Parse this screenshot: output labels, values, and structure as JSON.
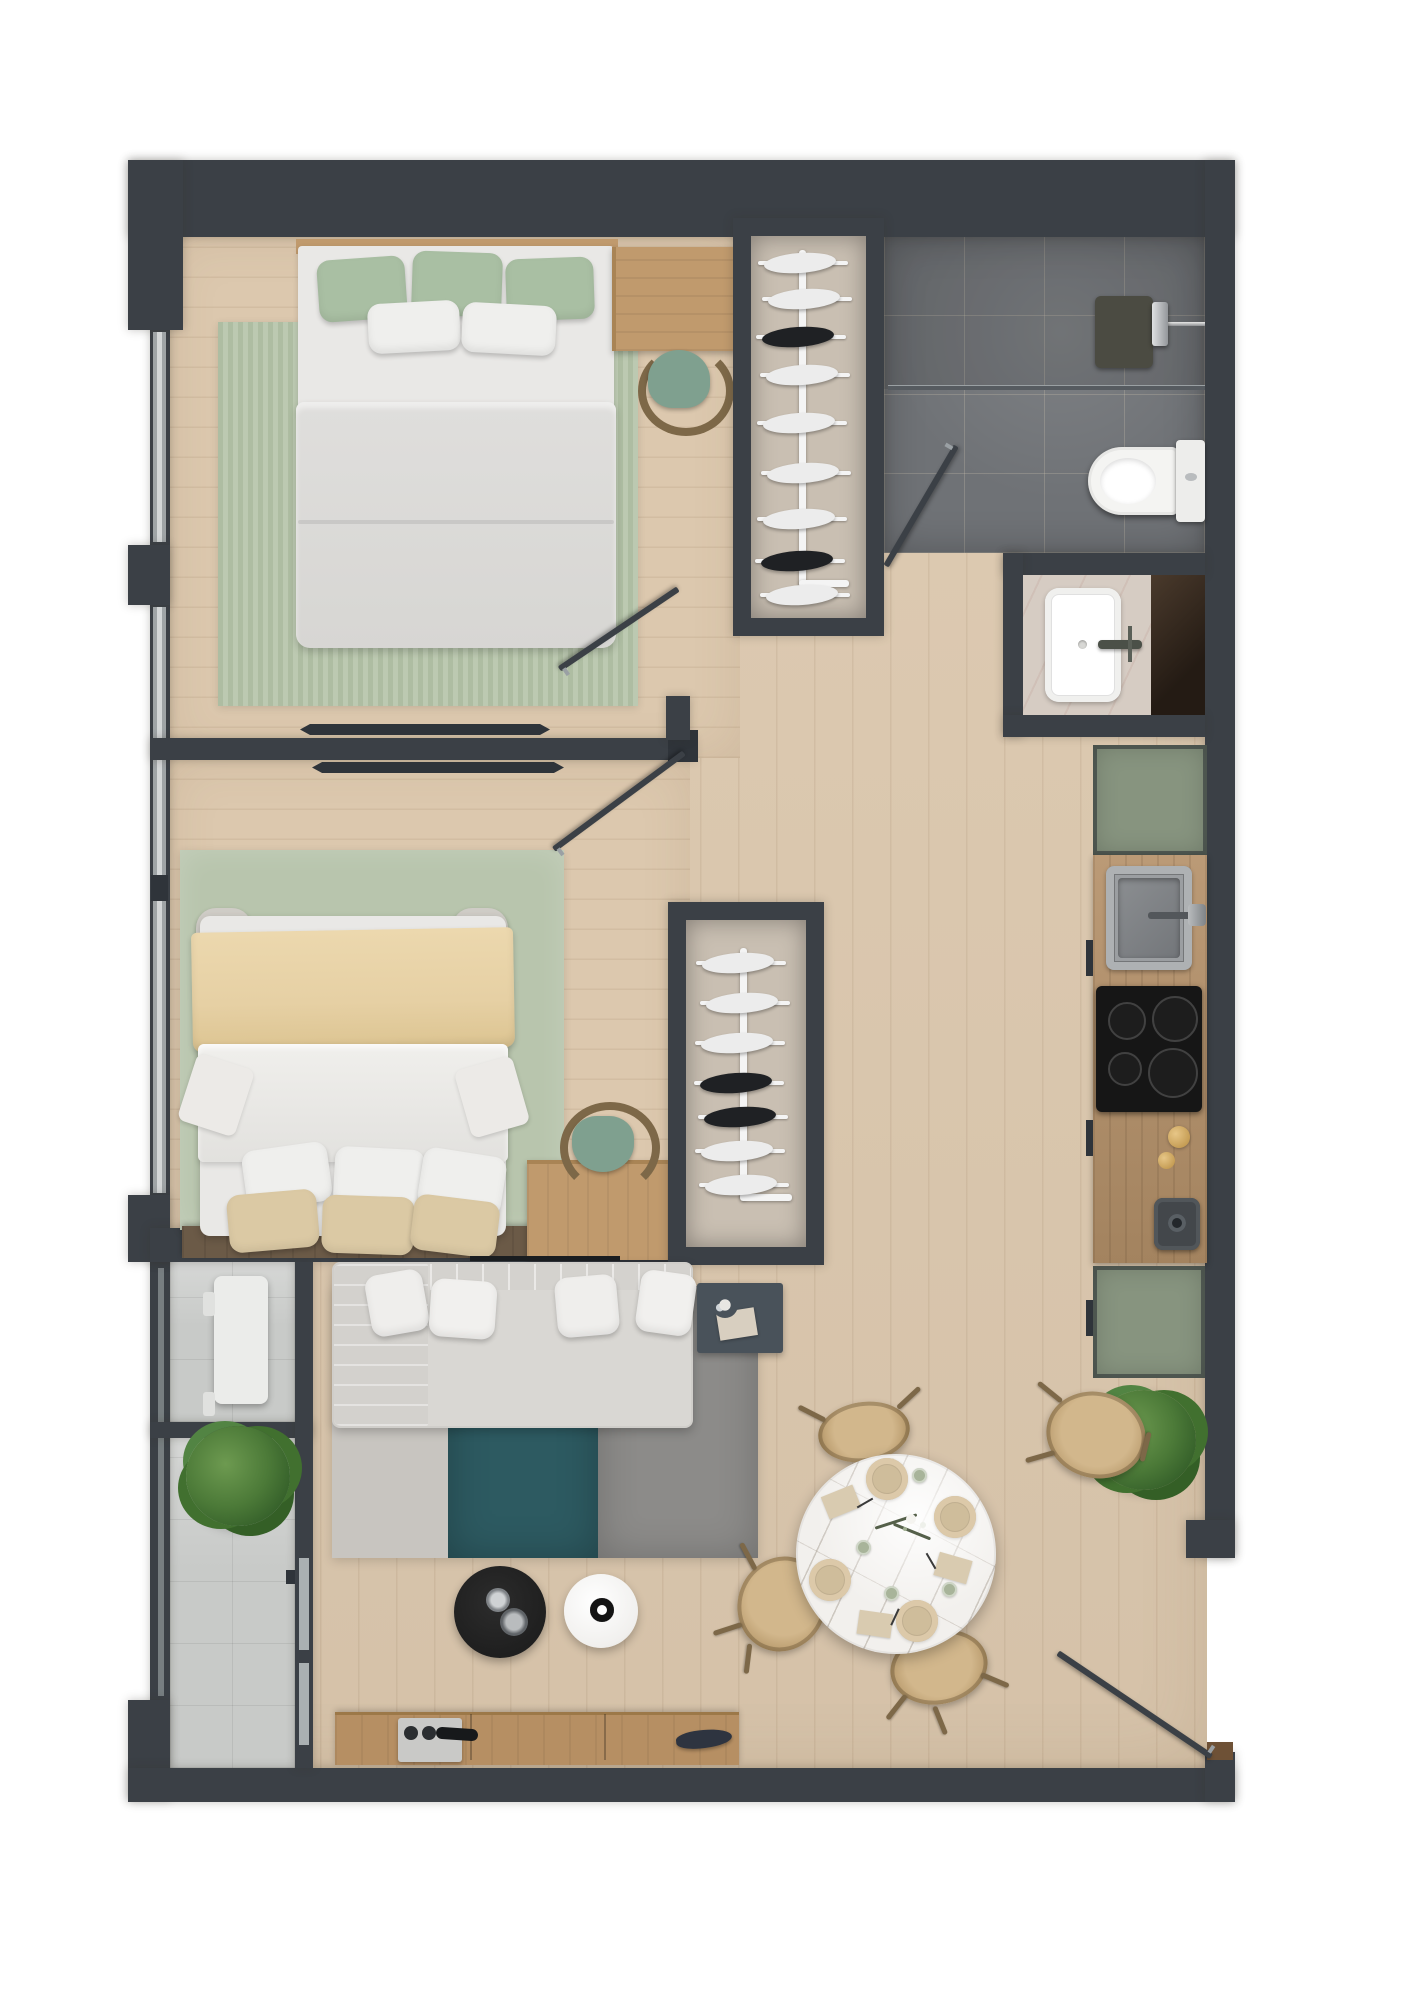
{
  "scene": {
    "type": "floor-plan-render",
    "view": "top-down",
    "layout": "two bedrooms, bathroom, open kitchen-living-dining, balcony"
  },
  "colors": {
    "wall": "#3b4046",
    "wallDark": "#2f343a",
    "floor": "#dcc8ae",
    "bathTile": "#6f7276",
    "balconyTile": "#c8cac8",
    "rugStripeA": "#aebda2",
    "rugStripeB": "#bcc9b1",
    "rugGreen": "#b8c5ad",
    "rugLight": "#c8c5c0",
    "rugTeal": "#2d5a61",
    "rugGray": "#8c8b89",
    "mattress": "#e9e8e6",
    "duvet": "#dfdedc",
    "pillowWhite": "#efefed",
    "pillowGreen": "#a9bfa3",
    "pillowBeige": "#dbc9a4",
    "blanket": "#e6d0a4",
    "woodFurn": "#c09a6d",
    "woodFurnDark": "#a98455",
    "counterWood": "#b5916e",
    "greenCab": "#87947f",
    "cooktop": "#161616",
    "sinkGray": "#94979a",
    "marble": "#f2f0ed",
    "vanityStone": "#d6ccc3",
    "darkStore": "#32281f",
    "rattan": "#c2a578",
    "stickWood": "#7d6848",
    "sofa": "#d9d7d3",
    "tableBlack": "#1f1f1f",
    "tableWhite": "#f1f0ee",
    "console": "#b68f63",
    "rail": "#f4f4f4",
    "clothes": "#ececec",
    "clothesDark": "#1f2124",
    "plantA": "#4c7a38",
    "plantB": "#35602a",
    "glass": "#aab0b2",
    "cupGreen": "#a8b49a",
    "mat": "#6e5136",
    "headboardShelf": "#6b5a47"
  },
  "inventory": {
    "bedroom_primary": [
      "double-bed",
      "green-and-white-pillows",
      "striped-green-rug",
      "desk",
      "green-chair",
      "open-wardrobe-rack"
    ],
    "bedroom_secondary": [
      "double-bed",
      "cream-blanket",
      "six-pillows",
      "green-rug",
      "desk",
      "green-chair"
    ],
    "bathroom": [
      "walk-in-shower",
      "glass-screen",
      "shower-set",
      "toilet",
      "vanity-basin",
      "utility-closet"
    ],
    "kitchen": [
      "green-cabinet-upper",
      "gray-sink",
      "induction-cooktop",
      "wood-counter",
      "green-cabinet-lower",
      "small-appliance",
      "potted-plant"
    ],
    "living": [
      "sofa-with-chaise",
      "four-cushions",
      "side-table",
      "three-tone-rug",
      "black-coffee-table",
      "white-coffee-table",
      "media-console",
      "wall-tv"
    ],
    "dining": [
      "round-marble-table",
      "four-rattan-chairs",
      "place-settings"
    ],
    "balcony": [
      "white-bench",
      "potted-plant",
      "tiled-floor"
    ],
    "doors": [
      "bedroom1-swing-door",
      "bedroom2-swing-door",
      "bathroom-swing-door",
      "entry-door",
      "sliding-panels"
    ]
  }
}
